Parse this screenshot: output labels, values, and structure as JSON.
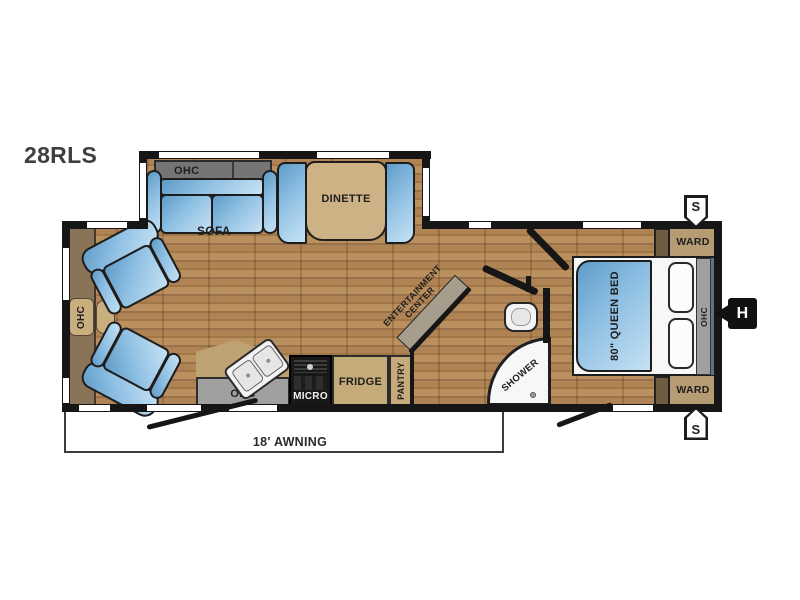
{
  "model": "28RLS",
  "slideout": {
    "ohc": "OHC",
    "sofa": "SOFA",
    "dinette": "DINETTE"
  },
  "front": {
    "ohc": "OHC"
  },
  "kitchen": {
    "ohc": "OHC",
    "micro": "MICRO",
    "fridge": "FRIDGE",
    "pantry": "PANTRY"
  },
  "entertainment": {
    "line1": "ENTERTAINMENT",
    "line2": "CENTER"
  },
  "bathroom": {
    "shower": "SHOWER"
  },
  "bedroom": {
    "bed": "80\" QUEEN BED",
    "ohc": "OHC",
    "ward_top": "WARD",
    "ward_bottom": "WARD"
  },
  "markers": {
    "speaker_top": "S",
    "speaker_bottom": "S",
    "hitch": "H"
  },
  "awning": {
    "label": "18' AWNING"
  },
  "colors": {
    "wall": "#161616",
    "floor_base": "#ae8352",
    "furniture_blue": "#8fc0e3",
    "cabinet_tan": "#c3a97b",
    "cabinet_gray": "#9c9c9c",
    "ohc_dark_gray": "#757575",
    "accent_blue_gray": "#5c7387"
  }
}
